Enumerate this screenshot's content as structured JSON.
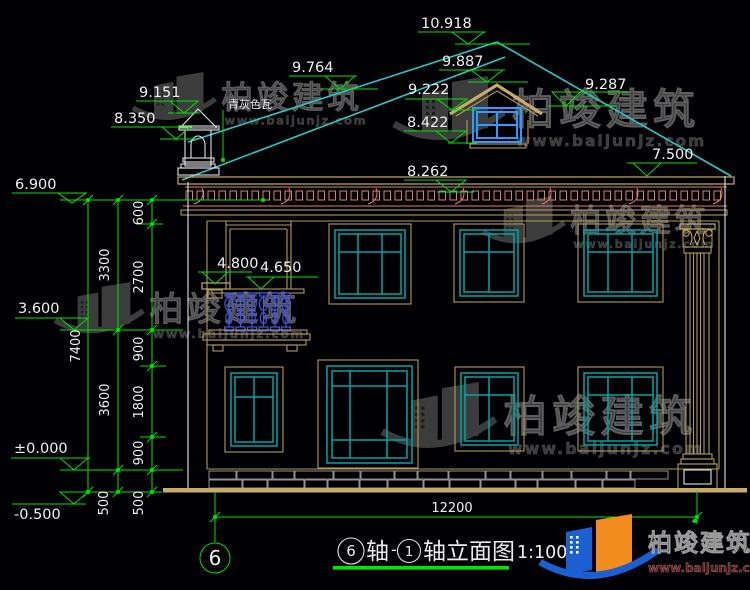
{
  "drawing": {
    "roof_label": "青灰色瓦",
    "axis_bubble": "6",
    "title": {
      "axis_from": "6",
      "zhou1": "轴",
      "dash": "-",
      "axis_to": "1",
      "suffix": "轴立面图",
      "scale": "1:100"
    }
  },
  "elevations": {
    "peak": "10.918",
    "dormer_ridge": "9.887",
    "roof_upper_left": "9.764",
    "roof_left": "9.222",
    "roof_right": "9.287",
    "dormer_sill": "8.422",
    "cupola_top": "9.151",
    "cupola_mid": "8.350",
    "eave_soffit": "8.262",
    "eave_right": "7.500",
    "cornice": "6.900",
    "ledge": "4.800",
    "balcony_rail": "4.650",
    "floor2": "3.600",
    "floor0": "±0.000",
    "ground": "-0.500"
  },
  "dimensions": {
    "overall_height": "7400",
    "upper_floor": "3300",
    "lower_floor": "3600",
    "seg_600": "600",
    "seg_2700": "2700",
    "seg_900_top": "900",
    "seg_1800": "1800",
    "seg_900_bottom": "900",
    "seg_500_left": "500",
    "seg_500_right": "500",
    "overall_width": "12200"
  },
  "watermark": {
    "name": "柏竣建筑",
    "url": "www.baijunjz.com"
  },
  "logo": {
    "name": "柏竣建筑",
    "url": "www.baijunjz.com"
  },
  "colors": {
    "dimension_green": "#00e400",
    "roof_cyan": "#27c8c8",
    "window_teal": "#00a5a5",
    "casing_tan": "#b39a5a",
    "cornice_salmon": "#e0806a",
    "baluster_blue": "#4257e8",
    "ground_tan": "#c9ab67",
    "dormer_blue": "#2d9bff",
    "text_white": "#f0f0f0"
  }
}
